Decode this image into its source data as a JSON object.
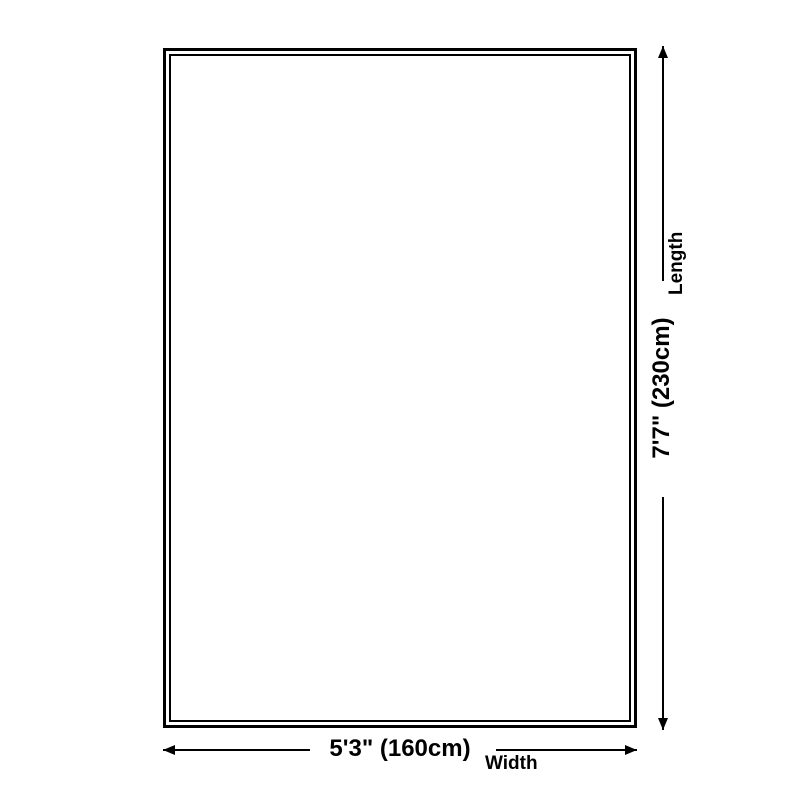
{
  "diagram": {
    "type": "product-size-diagram",
    "background_color": "#ffffff",
    "outline_color": "#000000",
    "text_color": "#000000",
    "length": {
      "value": "7'7\" (230cm)",
      "label": "Length"
    },
    "width": {
      "value": "5'3\" (160cm)",
      "label": "Width"
    }
  }
}
